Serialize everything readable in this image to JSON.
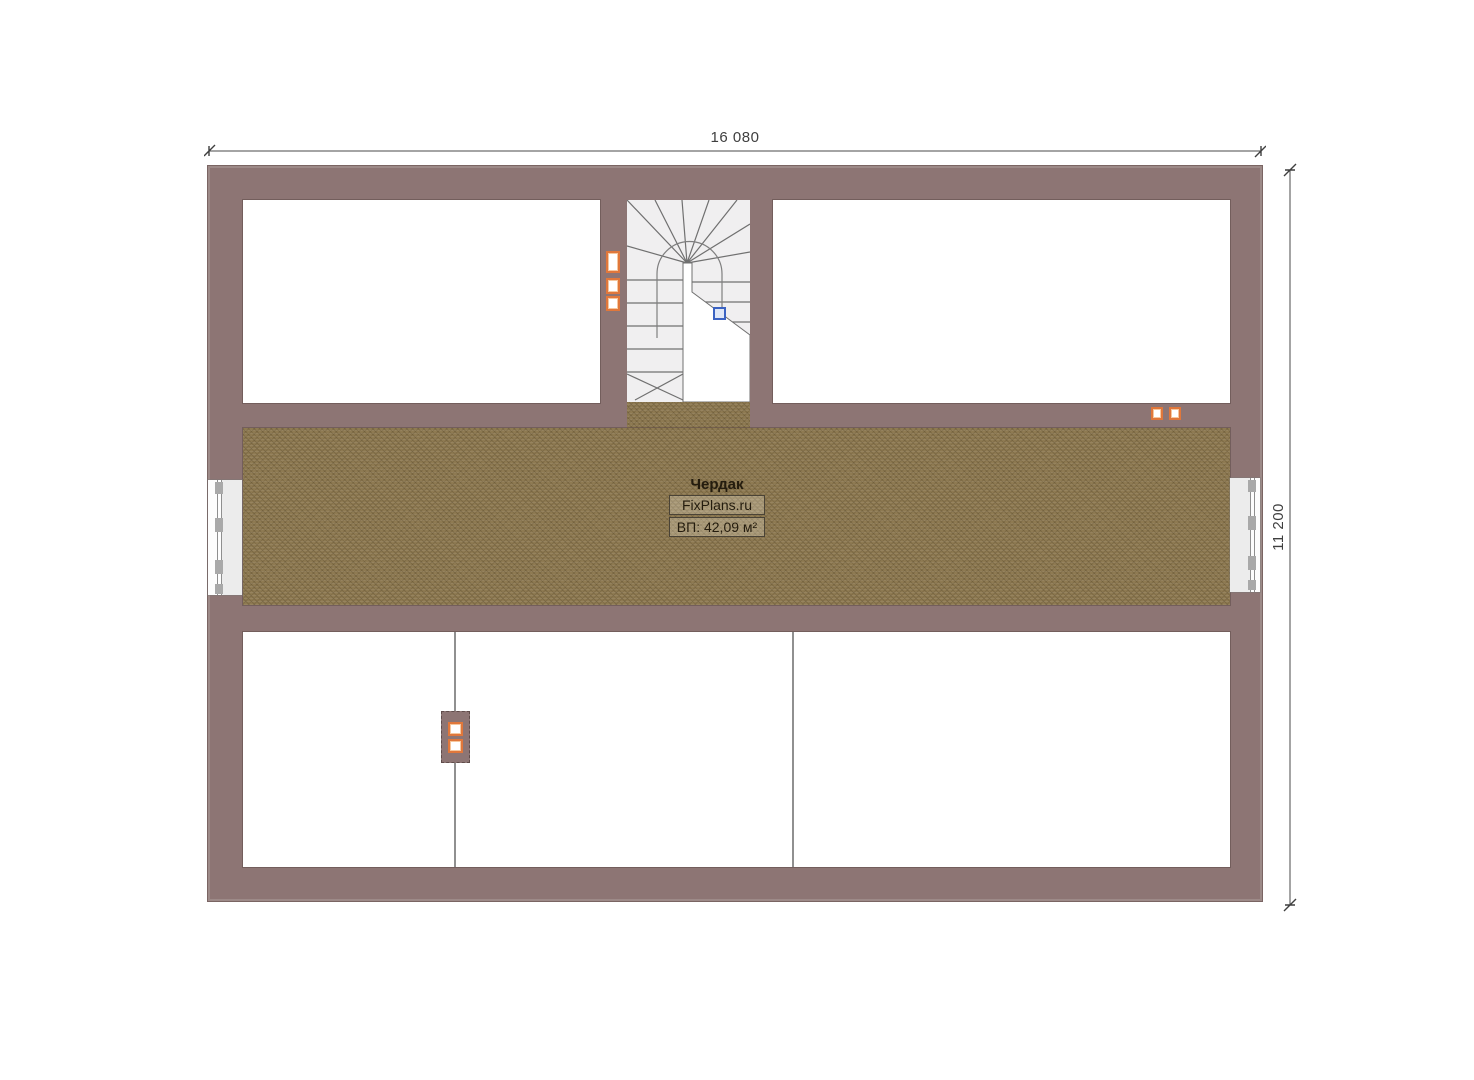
{
  "dimensions": {
    "width_label": "16 080",
    "height_label": "11 200"
  },
  "room_label": {
    "name": "Чердак",
    "brand": "FixPlans.ru",
    "area": "ВП: 42,09 м²"
  },
  "colors": {
    "wall": "#8d7574",
    "floor": "#8e7a52",
    "stair_bg": "#f0eff0",
    "stair_line": "#707070",
    "accent_orange": "#e0773b",
    "marker_blue": "#3a62c2",
    "dim": "#3f3f3f"
  }
}
